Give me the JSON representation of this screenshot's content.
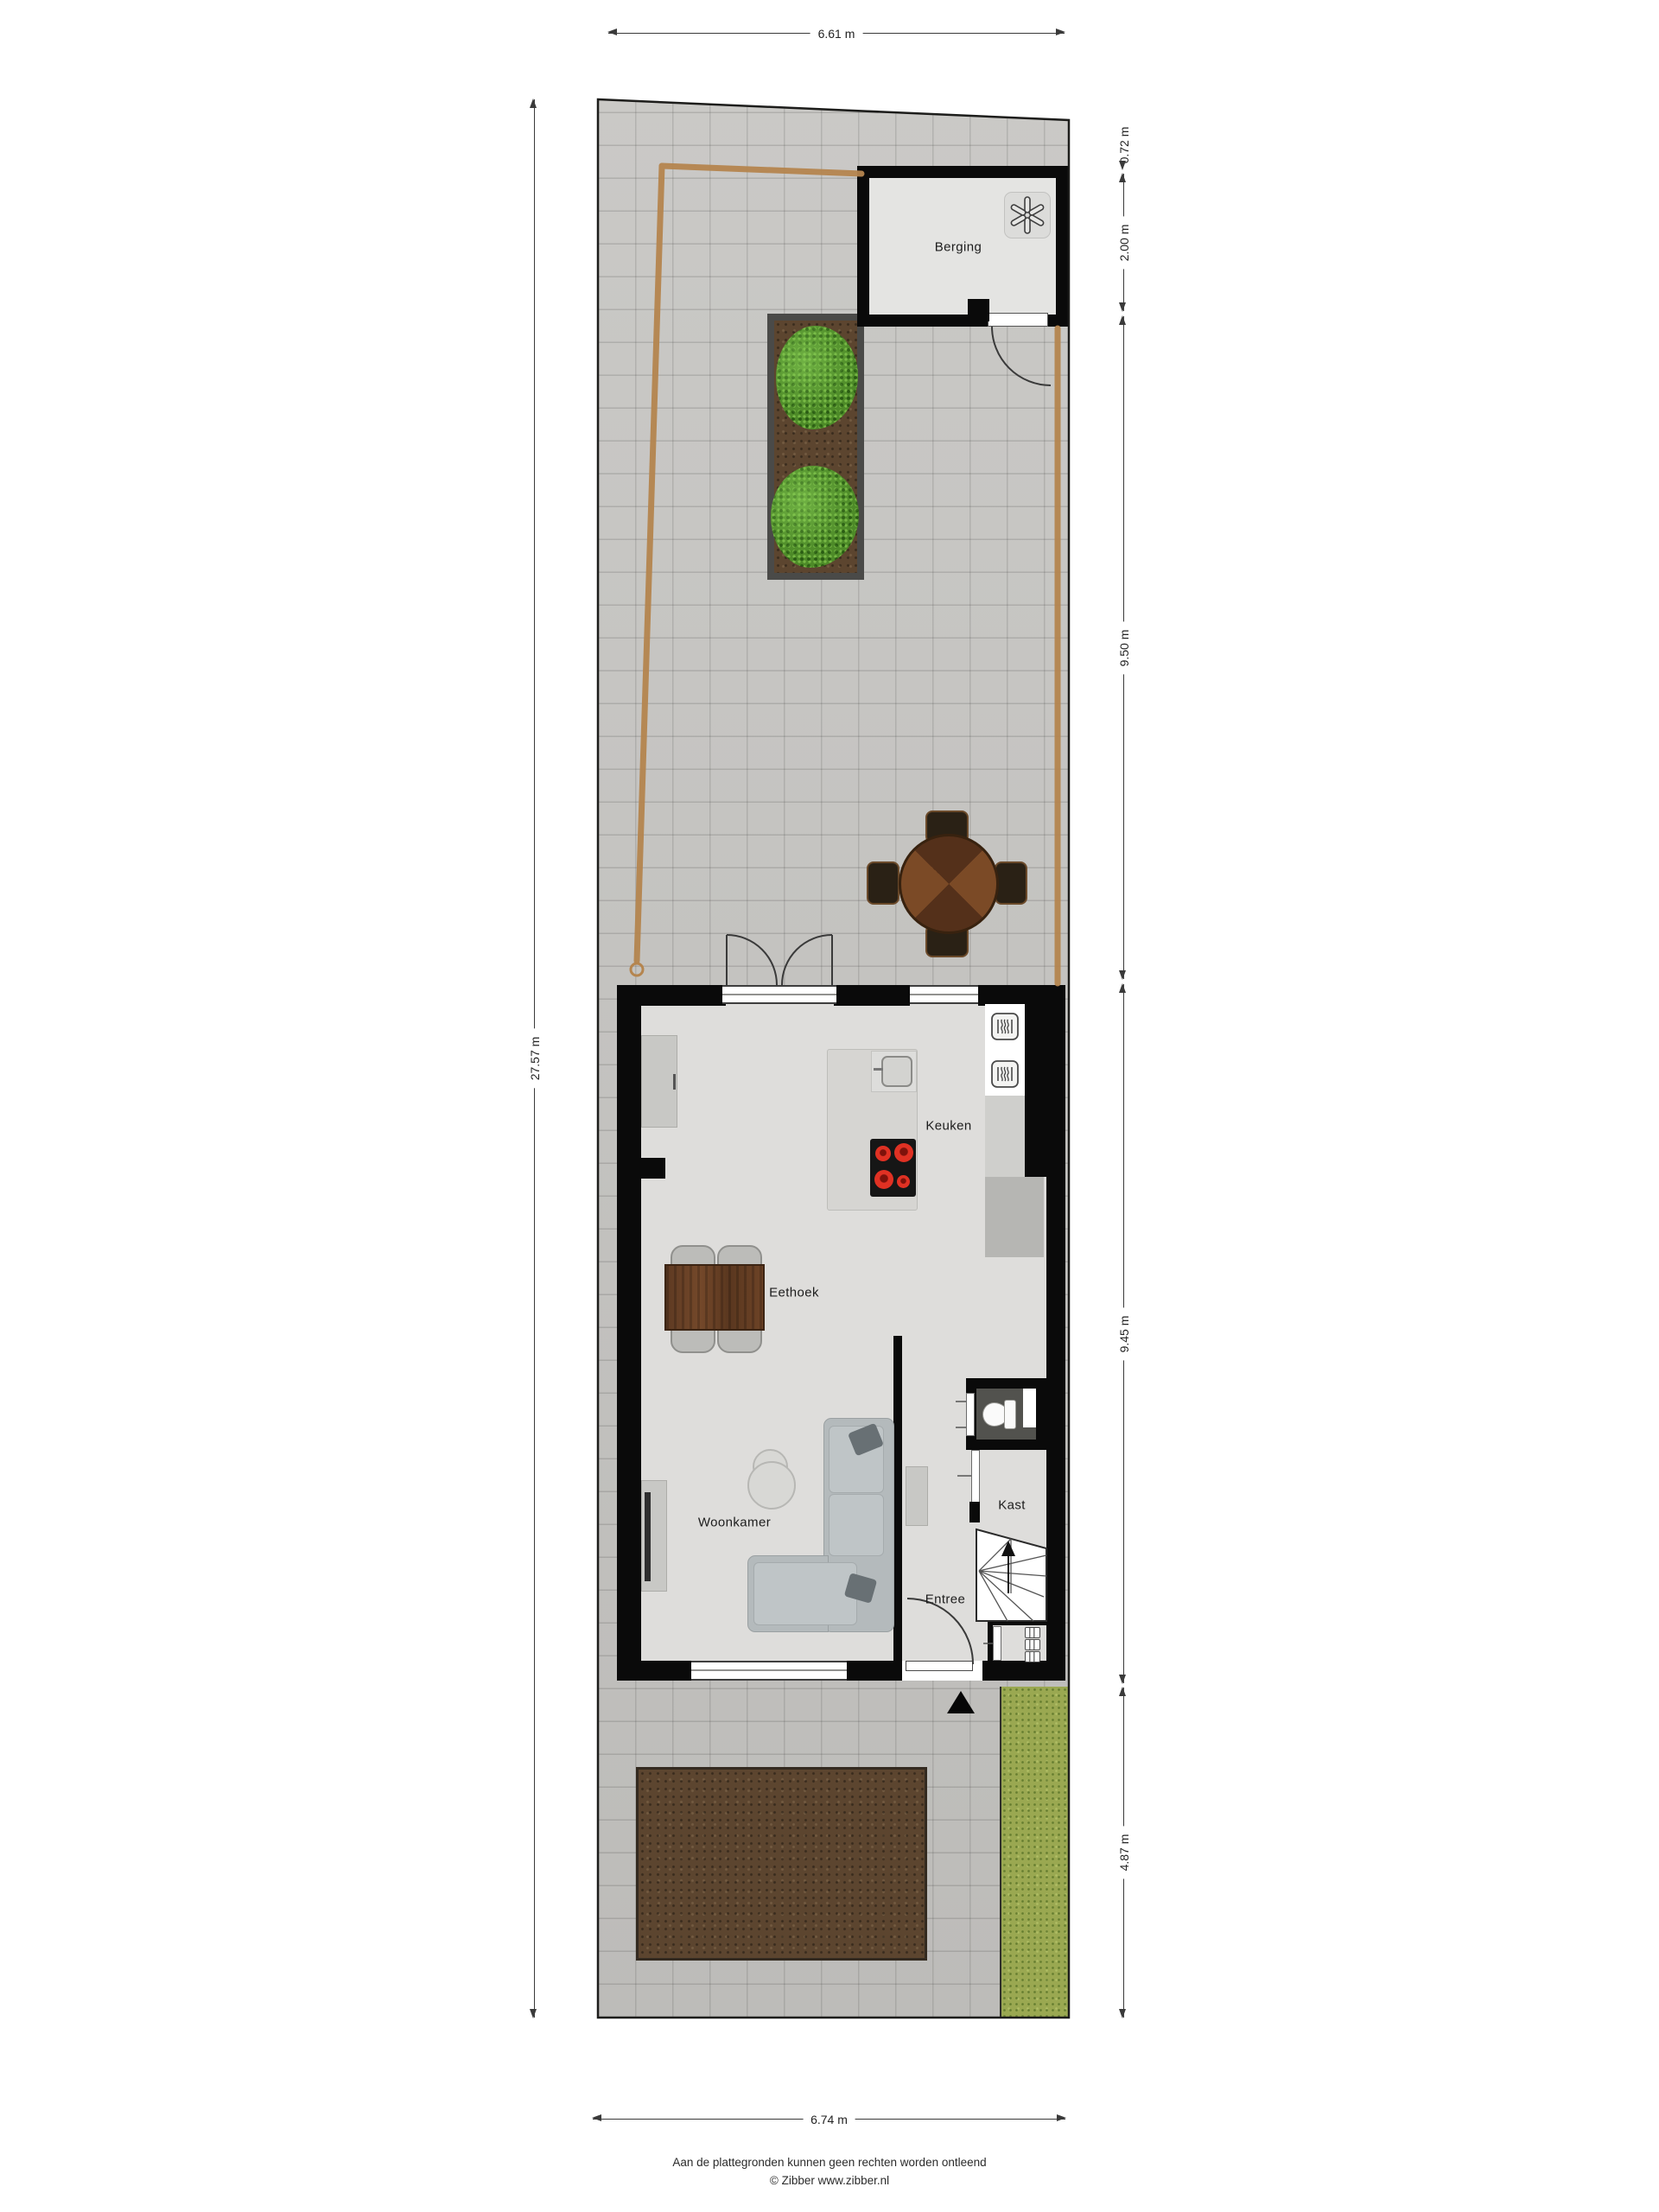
{
  "dimensions": {
    "top": "6.61 m",
    "bottom": "6.74 m",
    "left": "27.57 m",
    "right": [
      "0.72 m",
      "2.00 m",
      "9.50 m",
      "9.45 m",
      "4.87 m"
    ]
  },
  "rooms": {
    "berging": "Berging",
    "keuken": "Keuken",
    "eethoek": "Eethoek",
    "woonkamer": "Woonkamer",
    "entree": "Entree",
    "kast": "Kast"
  },
  "footer": {
    "line1": "Aan de plattegronden kunnen geen rechten worden ontleend",
    "line2": "© Zibber www.zibber.nl"
  },
  "icons": {
    "ventilation_unit": "six-spoke fan asterisk",
    "oven": "rounded square with heat waves",
    "hob": "four red burners",
    "sink": "square basin with tap",
    "toilet": "bowl with cistern",
    "stairs": "winder stairs with up arrow",
    "entrance_arrow": "solid triangle pointing up",
    "meter_cupboard": "three meter modules"
  },
  "colors": {
    "paving": "#c7c6c3",
    "grass": "#9aa851",
    "soil": "#5c452f",
    "fence": "#b5854f",
    "wall": "#0a0a0a",
    "floor": "#dedddb",
    "hob_accent": "#e03123",
    "wood_dark": "#54301a",
    "wood_light": "#7b4a26",
    "sofa": "#b4babc"
  }
}
